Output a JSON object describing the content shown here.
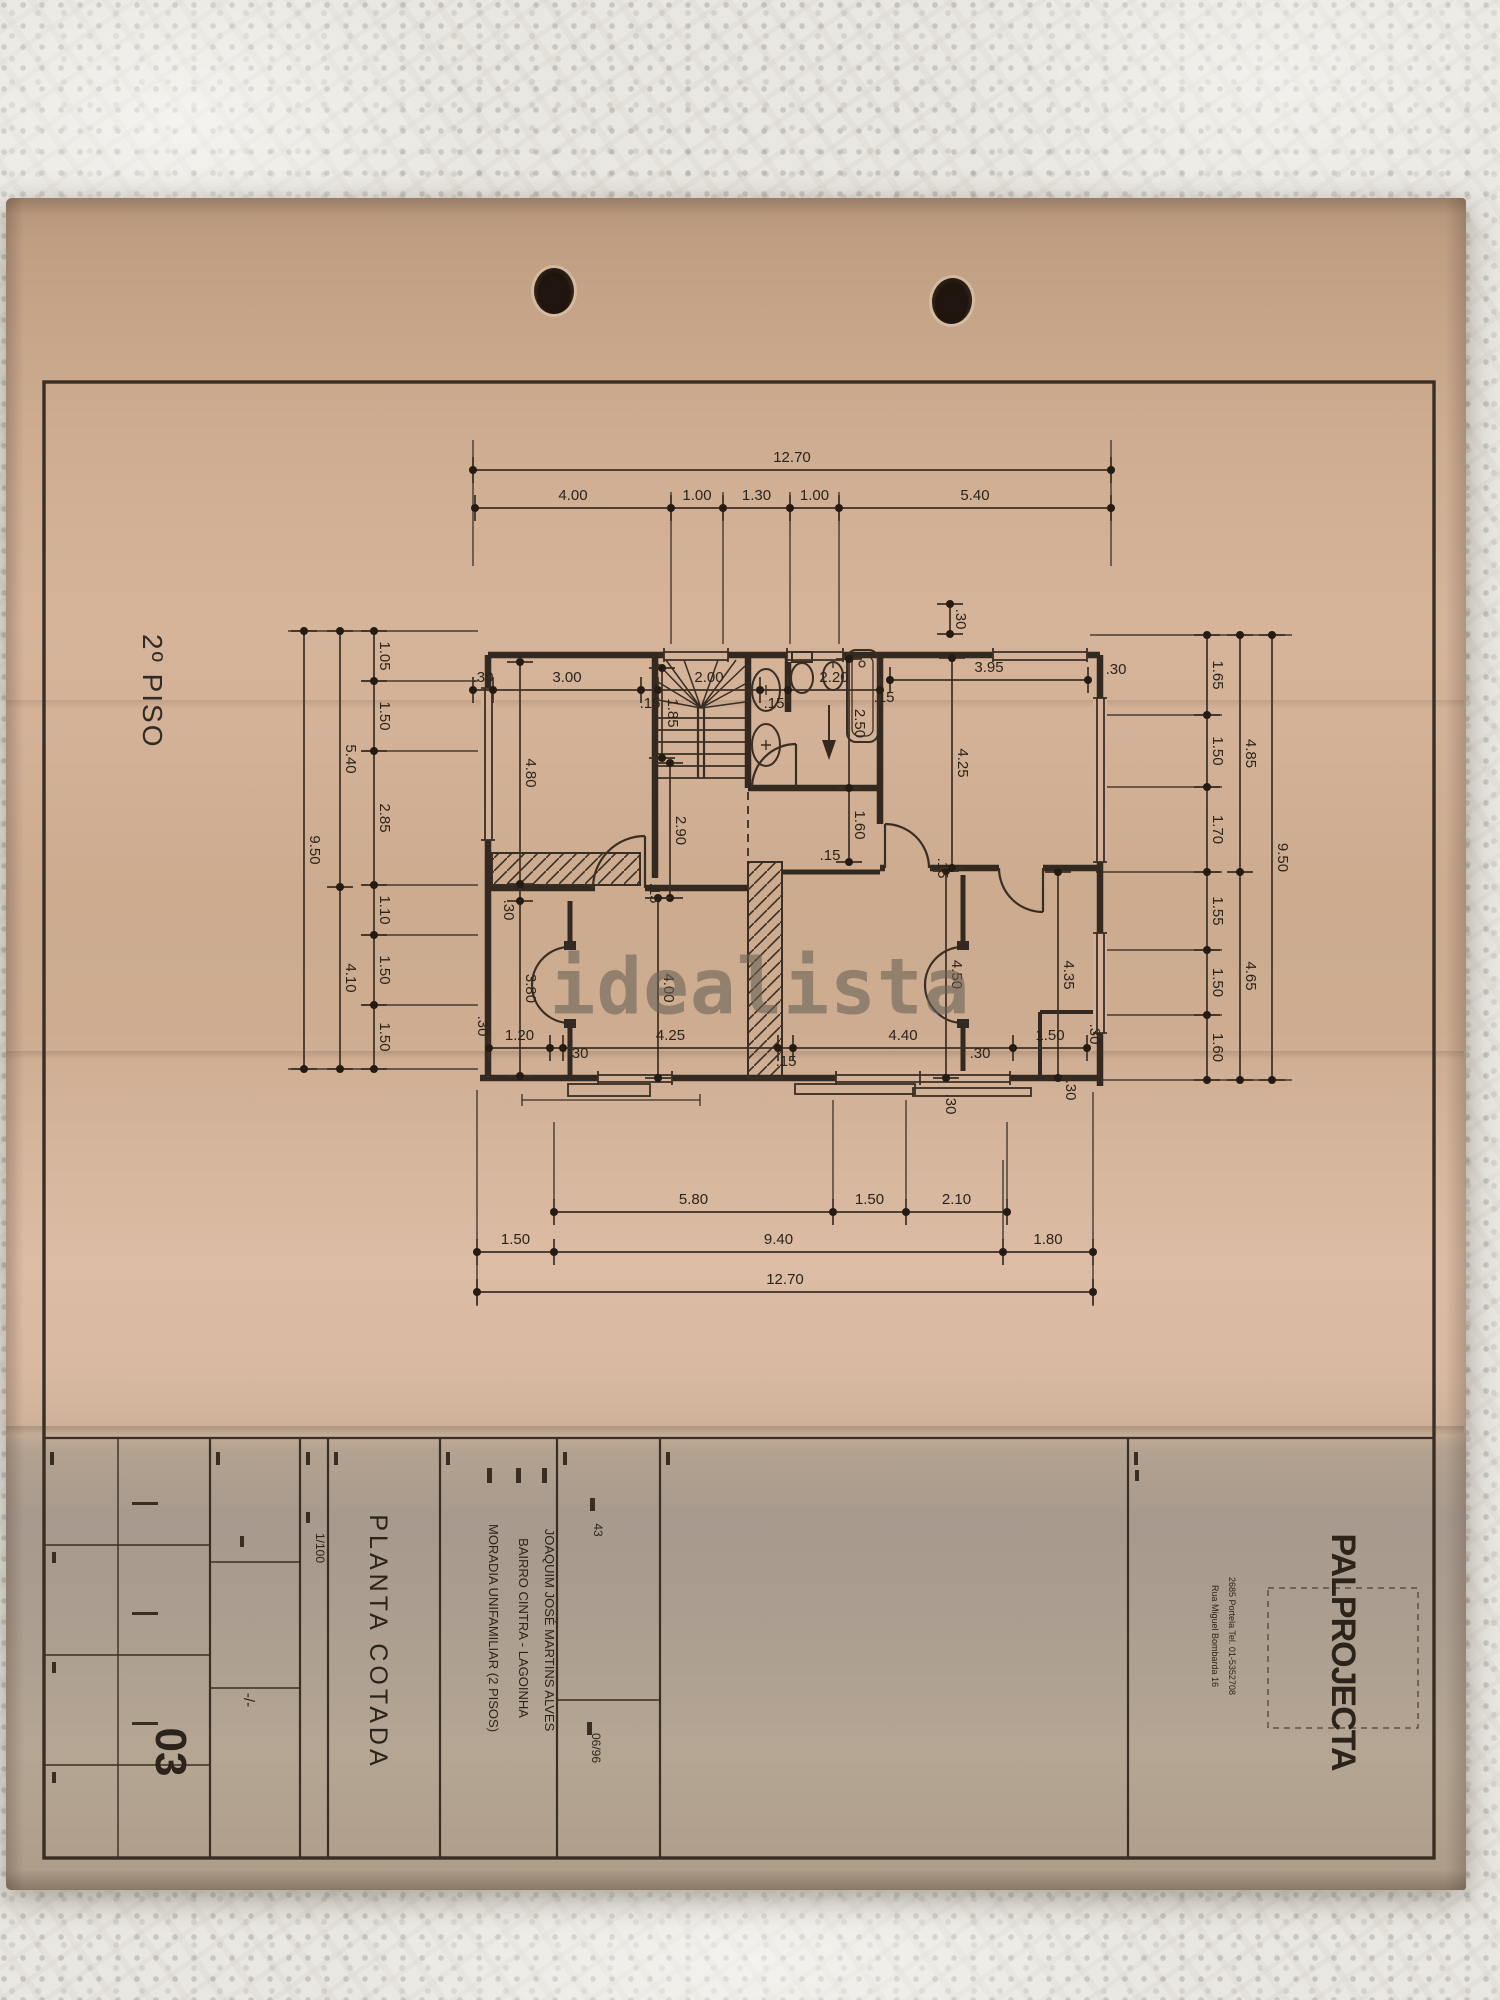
{
  "watermark": {
    "text": "idealista"
  },
  "floor_label": "2º PISO",
  "sheet": {
    "title": "PLANTA COTADA",
    "scale": "1/100",
    "client": "JOAQUIM JOSÉ MARTINS ALVES",
    "location": "BAIRRO CINTRA  -  LAGOINHA",
    "project": "MORADIA UNIFAMILIAR (2 PISOS)",
    "process_no": "43",
    "date": "06/96",
    "sheet_no": "03",
    "ratio_mark": "-/-",
    "firm": "PALPROJECTA",
    "firm_address_1": "Rua Miguel Bombarda 16",
    "firm_address_2": "2685 Portela  Tel. 01-5352708"
  },
  "colors": {
    "paper_tan": "#d0af94",
    "paper_gray_band": "#a79a8e",
    "ink": "#3a2e23",
    "dot": "#241b12",
    "fabric": "#e9e7e1",
    "watermark_gray": "rgba(104,97,85,0.58)"
  },
  "drawing": {
    "chains": [
      {
        "d": "h",
        "p": 470,
        "pts": [
          473,
          1111
        ],
        "labs": [
          "12.70"
        ]
      },
      {
        "d": "h",
        "p": 508,
        "pts": [
          475,
          671,
          723,
          790,
          839,
          1111
        ],
        "labs": [
          "4.00",
          "1.00",
          "1.30",
          "1.00",
          "5.40"
        ]
      },
      {
        "d": "h",
        "p": 690,
        "pts": [
          473,
          493,
          641,
          658,
          760,
          788,
          880
        ],
        "labs": [
          ".30",
          "3.00",
          "",
          "2.00",
          "",
          "2.20"
        ]
      },
      {
        "d": "h",
        "p": 680,
        "pts": [
          890,
          1088
        ],
        "labs": [
          "3.95"
        ]
      },
      {
        "d": "h",
        "p": 1048,
        "pts": [
          489,
          550,
          563,
          778,
          793,
          1013,
          1087
        ],
        "labs": [
          "1.20",
          "",
          "4.25",
          "",
          "4.40",
          "1.50"
        ]
      },
      {
        "d": "h",
        "p": 1212,
        "pts": [
          554,
          833,
          906,
          1007
        ],
        "labs": [
          "5.80",
          "1.50",
          "2.10"
        ]
      },
      {
        "d": "h",
        "p": 1252,
        "pts": [
          477,
          554,
          1003,
          1093
        ],
        "labs": [
          "1.50",
          "9.40",
          "1.80"
        ]
      },
      {
        "d": "h",
        "p": 1292,
        "pts": [
          477,
          1093
        ],
        "labs": [
          "12.70"
        ]
      },
      {
        "d": "v",
        "p": 374,
        "pts": [
          631,
          681,
          751,
          885,
          935,
          1005,
          1069
        ],
        "labs": [
          "1.05",
          "1.50",
          "2.85",
          "1.10",
          "1.50",
          "1.50"
        ]
      },
      {
        "d": "v",
        "p": 340,
        "pts": [
          631,
          887,
          1069
        ],
        "labs": [
          "5.40",
          "4.10"
        ]
      },
      {
        "d": "v",
        "p": 304,
        "pts": [
          631,
          1069
        ],
        "labs": [
          "9.50"
        ]
      },
      {
        "d": "v",
        "p": 1207,
        "pts": [
          635,
          715,
          787,
          872,
          950,
          1015,
          1080
        ],
        "labs": [
          "1.65",
          "1.50",
          "1.70",
          "1.55",
          "1.50",
          "1.60"
        ]
      },
      {
        "d": "v",
        "p": 1240,
        "pts": [
          635,
          872,
          1080
        ],
        "labs": [
          "4.85",
          "4.65"
        ]
      },
      {
        "d": "v",
        "p": 1272,
        "pts": [
          635,
          1080
        ],
        "labs": [
          "9.50"
        ]
      },
      {
        "d": "v",
        "p": 950,
        "pts": [
          604,
          634
        ],
        "labs": [
          ".30"
        ]
      },
      {
        "d": "v",
        "p": 662,
        "pts": [
          668,
          758
        ],
        "labs": [
          "1.85"
        ]
      },
      {
        "d": "v",
        "p": 670,
        "pts": [
          763,
          898
        ],
        "labs": [
          "2.90"
        ]
      },
      {
        "d": "v",
        "p": 849,
        "pts": [
          659,
          788,
          862
        ],
        "labs": [
          "2.50",
          "1.60"
        ]
      },
      {
        "d": "v",
        "p": 520,
        "pts": [
          662,
          884,
          901,
          1076
        ],
        "labs": [
          "4.80",
          "",
          "3.80"
        ]
      },
      {
        "d": "v",
        "p": 658,
        "pts": [
          898,
          1078
        ],
        "labs": [
          "4.00"
        ]
      },
      {
        "d": "v",
        "p": 946,
        "pts": [
          871,
          1078
        ],
        "labs": [
          "4.50"
        ]
      },
      {
        "d": "v",
        "p": 1058,
        "pts": [
          872,
          1078
        ],
        "labs": [
          "4.35"
        ]
      },
      {
        "d": "v",
        "p": 952,
        "pts": [
          658,
          868
        ],
        "labs": [
          "4.25"
        ]
      }
    ],
    "texts": [
      {
        "t": ".15",
        "x": 650,
        "y": 708
      },
      {
        "t": ".15",
        "x": 774,
        "y": 708
      },
      {
        "t": ".15",
        "x": 884,
        "y": 702
      },
      {
        "t": ".15",
        "x": 830,
        "y": 860
      },
      {
        "t": ".15",
        "x": 650,
        "y": 893,
        "r": 90
      },
      {
        "t": ".15",
        "x": 938,
        "y": 868,
        "r": 90
      },
      {
        "t": ".15",
        "x": 786,
        "y": 1066
      },
      {
        "t": ".30",
        "x": 1116,
        "y": 674
      },
      {
        "t": ".30",
        "x": 504,
        "y": 910,
        "r": 90
      },
      {
        "t": ".30",
        "x": 578,
        "y": 1058
      },
      {
        "t": ".30",
        "x": 980,
        "y": 1058
      },
      {
        "t": ".30",
        "x": 478,
        "y": 1026,
        "r": 90
      },
      {
        "t": ".30",
        "x": 1090,
        "y": 1034,
        "r": 90
      },
      {
        "t": ".30",
        "x": 1066,
        "y": 1090,
        "r": 90
      },
      {
        "t": ".30",
        "x": 946,
        "y": 1104,
        "r": 90
      },
      {
        "ref": "sheet.scale",
        "x": 316,
        "y": 1548,
        "r": 90,
        "s": 12
      },
      {
        "ref": "sheet.title",
        "x": 370,
        "y": 1642,
        "r": 90,
        "s": 25,
        "ls": 4
      },
      {
        "ref": "sheet.project",
        "x": 489,
        "y": 1628,
        "r": 90,
        "s": 13
      },
      {
        "ref": "sheet.location",
        "x": 519,
        "y": 1628,
        "r": 90,
        "s": 13
      },
      {
        "ref": "sheet.client",
        "x": 545,
        "y": 1630,
        "r": 90,
        "s": 13
      },
      {
        "ref": "sheet.process_no",
        "x": 594,
        "y": 1530,
        "r": 90,
        "s": 12
      },
      {
        "ref": "sheet.date",
        "x": 592,
        "y": 1748,
        "r": 90,
        "s": 12
      },
      {
        "ref": "sheet.ratio_mark",
        "x": 244,
        "y": 1700,
        "r": 90,
        "s": 15
      },
      {
        "ref": "sheet.sheet_no",
        "x": 156,
        "y": 1752,
        "r": 90,
        "s": 44,
        "w": 700
      },
      {
        "ref": "sheet.firm",
        "x": 1332,
        "y": 1652,
        "r": 90,
        "s": 34,
        "w": 700,
        "ls": -1
      },
      {
        "ref": "sheet.firm_address_1",
        "x": 1212,
        "y": 1636,
        "r": 90,
        "s": 9
      },
      {
        "ref": "sheet.firm_address_2",
        "x": 1229,
        "y": 1636,
        "r": 90,
        "s": 9
      }
    ]
  }
}
